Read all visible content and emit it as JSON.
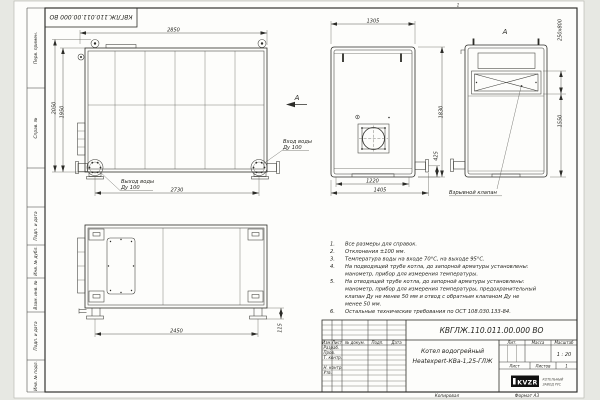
{
  "frame": {
    "top_stamp": "КВГЛЖ.110.011.00.000 ВО",
    "zone_mark": "1",
    "margin_labels": {
      "perv_primen": "Перв. примен.",
      "sprav_no": "Справ. №",
      "podp_data_1": "Подп. и дата",
      "inv_dubl": "Инв. № дубл.",
      "vzam_inv": "Взам. инв. №",
      "podp_data_2": "Подп. и дата",
      "inv_podl": "Инв. № подл."
    },
    "copied_label": "Копировал",
    "format_label": "Формат А3"
  },
  "views": {
    "side": {
      "dim_width_top": "2850",
      "dim_height_outer": "2050",
      "dim_height_inner": "1950",
      "dim_width_bottom": "2730",
      "outlet_line1": "Выход воды",
      "outlet_line2": "Ду 100",
      "inlet_line1": "Вход воды",
      "inlet_line2": "Ду 100",
      "view_arrow_label": "А"
    },
    "front": {
      "dim_width_top": "1305",
      "dim_height": "1830",
      "dim_width_inner": "1220",
      "dim_width_outer": "1405",
      "dim_pipe_height": "425"
    },
    "rear": {
      "view_label": "А",
      "dim_valve": "250х800",
      "dim_height": "1550",
      "valve_label": "Взрывной клапан"
    },
    "top": {
      "dim_width": "2450",
      "dim_feet": "115"
    }
  },
  "notes": {
    "nums": [
      "1.",
      "2.",
      "3.",
      "4.",
      "5.",
      "6."
    ],
    "lines": [
      "Все размеры для справок.",
      "Отклонения ±100 мм.",
      "Температура воды на входе 70°С, на выходе 95°С.",
      "На подводящей трубе котла, до запорной арматуры установлены:",
      "манометр, прибор для измерения температуры.",
      "На отводящей трубе котла, до запорной арматуры установлены:",
      "манометр, прибор для измерения температуры, предохранительный",
      "клапан Ду не менее 50 мм и отвод с обратным клапаном Ду не",
      "менее 50 мм.",
      "Остальные технические требования по ОСТ 108.030.133-84."
    ]
  },
  "title_block": {
    "designation": "КВГЛЖ.110.011.00.000 ВО",
    "product_name_1": "Котел водогрейный",
    "product_name_2": "Heatexpert-КВа-1,25-ГЛЖ",
    "col_izm": "Изм.",
    "col_list": "Лист",
    "col_doc": "№ докум.",
    "col_sign": "Подп.",
    "col_date": "Дата",
    "row_developed": "Разраб.",
    "row_checked": "Пров.",
    "row_tcontrol": "Т. контр.",
    "row_ncontrol": "Н. контр.",
    "row_approved": "Утв.",
    "lit_header": "Лит.",
    "mass_header": "Масса",
    "scale_header": "Масштаб",
    "scale_value": "1 : 20",
    "sheet_header": "Лист",
    "sheets_header": "Листов",
    "sheets_value": "1",
    "logo_text": "KVZR",
    "company_line_1": "КОТЕЛЬНЫЙ",
    "company_line_2": "ЗАВОД РУС"
  }
}
